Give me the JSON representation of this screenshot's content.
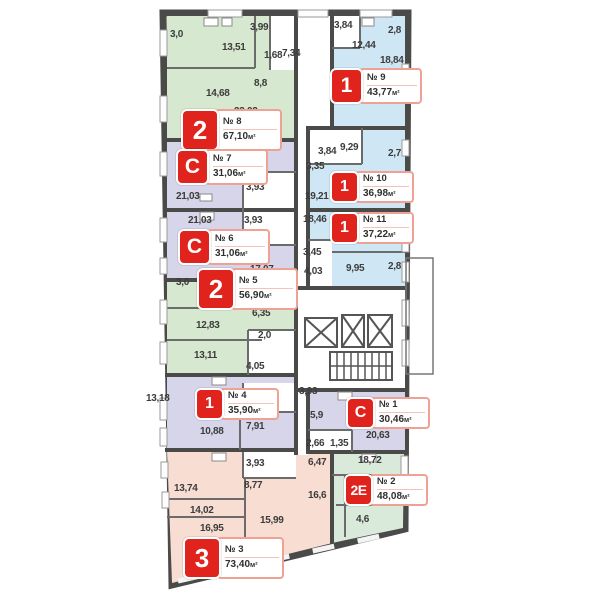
{
  "units": {
    "m2": "м²"
  },
  "apartments": [
    {
      "key": "8",
      "type": "2",
      "number": "№ 8",
      "area": "67,10"
    },
    {
      "key": "9",
      "type": "1",
      "number": "№ 9",
      "area": "43,77"
    },
    {
      "key": "7",
      "type": "C",
      "number": "№ 7",
      "area": "31,06"
    },
    {
      "key": "6",
      "type": "C",
      "number": "№ 6",
      "area": "31,06"
    },
    {
      "key": "5",
      "type": "2",
      "number": "№ 5",
      "area": "56,90"
    },
    {
      "key": "10",
      "type": "1",
      "number": "№ 10",
      "area": "36,98"
    },
    {
      "key": "11",
      "type": "1",
      "number": "№ 11",
      "area": "37,22"
    },
    {
      "key": "4",
      "type": "1",
      "number": "№ 4",
      "area": "35,90"
    },
    {
      "key": "1",
      "type": "C",
      "number": "№ 1",
      "area": "30,46"
    },
    {
      "key": "2",
      "type": "2Е",
      "number": "№ 2",
      "area": "48,08"
    },
    {
      "key": "3",
      "type": "3",
      "number": "№ 3",
      "area": "73,40"
    }
  ],
  "rooms": [
    "3,0",
    "13,51",
    "3,99",
    "1,68",
    "7,34",
    "8,8",
    "14,68",
    "23,02",
    "3,84",
    "12,44",
    "2,8",
    "18,84",
    "3,84",
    "9,29",
    "2,7",
    "3,35",
    "19,21",
    "6,1",
    "3,93",
    "21,03",
    "21,03",
    "3,93",
    "6,1",
    "17,07",
    "18,46",
    "3,45",
    "4,03",
    "9,95",
    "2,8",
    "3,0",
    "6,35",
    "12,83",
    "2,0",
    "13,11",
    "4,05",
    "13,18",
    "3,93",
    "10,88",
    "7,91",
    "3,93",
    "5,9",
    "20,63",
    "2,66",
    "1,35",
    "6,47",
    "18,72",
    "16,6",
    "4,6",
    "3,93",
    "13,74",
    "8,77",
    "14,02",
    "16,95",
    "15,99"
  ],
  "colors": {
    "wall": "#4a4a49",
    "green": "#d6e8cf",
    "blue": "#cfe7f4",
    "lavender": "#d6d5e9",
    "pink": "#f8ddd2",
    "red": "#e0231d"
  }
}
